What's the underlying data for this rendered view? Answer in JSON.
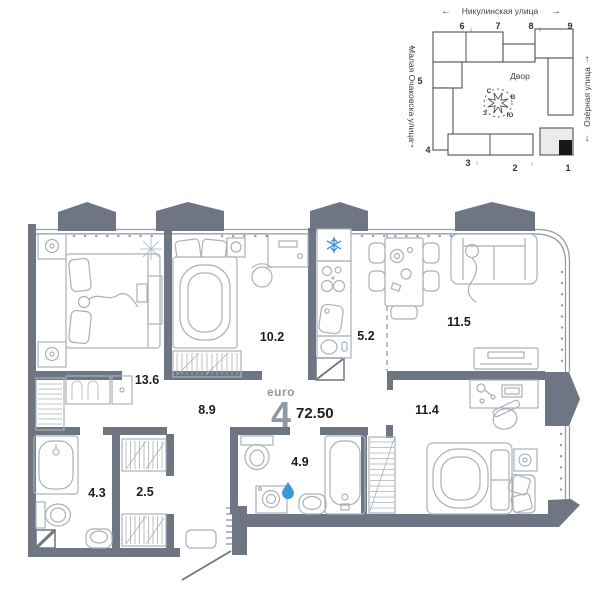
{
  "site_plan": {
    "streets": {
      "top": "Никулинская улица",
      "left": "Малая Очаковска улица",
      "right": "Озёрная улица"
    },
    "courtyard_label": "Двор",
    "compass": {
      "north": "С",
      "east": "В",
      "south": "Ю",
      "west": "З"
    },
    "building_numbers": {
      "b1": "1",
      "b2": "2",
      "b3": "3",
      "b4": "4",
      "b5": "5",
      "b6": "6",
      "b7": "7",
      "b8": "8",
      "b9": "9"
    }
  },
  "floor_plan": {
    "summary": {
      "type_label": "euro",
      "rooms_count": "4",
      "total_area": "72.50"
    },
    "rooms": {
      "bedroom_1": "13.6",
      "bedroom_2": "10.2",
      "kitchen": "5.2",
      "living_room": "11.5",
      "hallway": "8.9",
      "bedroom_3": "11.4",
      "bathroom_1": "4.3",
      "wardrobe": "2.5",
      "bathroom_2": "4.9"
    }
  },
  "icons": {
    "arrow_left": "←",
    "arrow_right": "→",
    "arrow_up": "↑",
    "arrow_down": "↓"
  },
  "colors": {
    "wall": "#6d7682",
    "furniture_line": "#a9b1b9",
    "window_line": "#959ea8",
    "accent_blue": "#3e97d3",
    "label_text": "#1d1d1f",
    "muted_text": "#8f99a3"
  }
}
